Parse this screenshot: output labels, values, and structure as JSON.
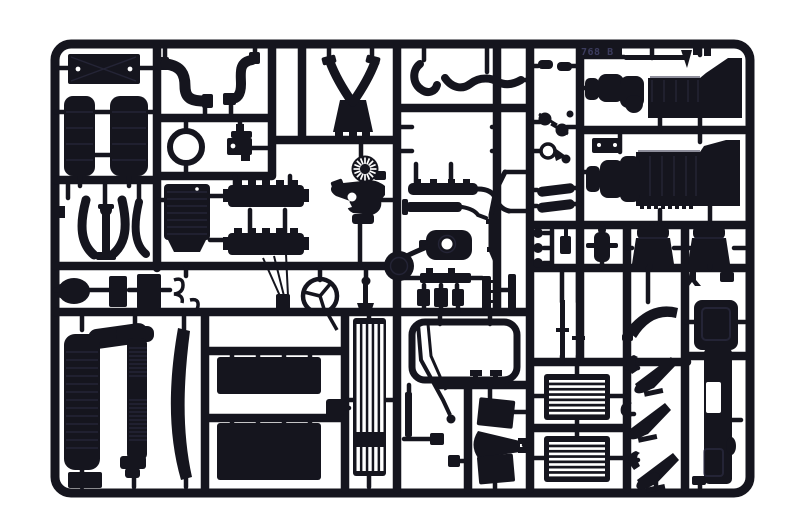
{
  "scene": {
    "description": "Photograph of a black injection-moulded plastic model-kit sprue (parts tree) with truck model parts, on a white background",
    "tag_text": "768 B"
  },
  "colors": {
    "background": "#ffffff",
    "plastic": "#15151e",
    "plastic_deep": "#08080d",
    "highlight": "#32324a",
    "cutout": "#ffffff",
    "tag_text": "#3c3c5e"
  },
  "parts_manifest": [
    "cross-braced-plate",
    "air-tank-left",
    "air-tank-right",
    "exhaust-elbow-pipe-left",
    "exhaust-elbow-pipe-right",
    "retaining-ring",
    "valve-bracket",
    "y-exhaust-manifold",
    "radiator-fan-and-pump",
    "ribbed-roof-panel",
    "wheel-arch-trim-1",
    "jack-column",
    "wheel-arch-trim-2",
    "wheel-arch-trim-3",
    "cylinder-head-bar-upper",
    "cylinder-head-bar-lower",
    "intercooler-bar-upper",
    "intercooler-bar-lower",
    "oval-pod",
    "battery-box-small",
    "battery-box-large",
    "battery-box-end",
    "spring-clip-upper",
    "spring-clip-lower",
    "antenna-cluster",
    "steering-wheel",
    "gear-lever",
    "center-gate-boss",
    "exhaust-stack-muffler",
    "flexible-exhaust-pipe",
    "curved-trim-blade",
    "step-block",
    "mud-flap-upper",
    "mud-flap-lower",
    "flap-bracket",
    "tall-front-grille",
    "window-frame",
    "window-frame-mounts",
    "diagonal-fuel-lines",
    "small-block-a",
    "small-block-b",
    "hinge-pin-strip-a",
    "hinge-pin-strip-b",
    "tab-bar",
    "block-row",
    "door-slab-upper",
    "intake-cone",
    "door-slab-lower",
    "radiator-core-upper",
    "radiator-core-lower",
    "air-horn-1",
    "air-horn-2",
    "air-horn-3",
    "cab-side-panel",
    "engine-block-upper",
    "engine-block-lower",
    "mounting-plate-two-holes",
    "linkage-rod",
    "twin-link",
    "belt-pulleys",
    "teardrop-ring",
    "shock-absorber-pair",
    "grommet-set",
    "wiper-arm",
    "mirror-housing",
    "seat-left",
    "seat-right",
    "air-filter-canister",
    "valve-cover-bar-upper",
    "valve-cover-bar-lower",
    "gearbox-sump",
    "wavy-fuel-pipe",
    "hook-pipe"
  ]
}
